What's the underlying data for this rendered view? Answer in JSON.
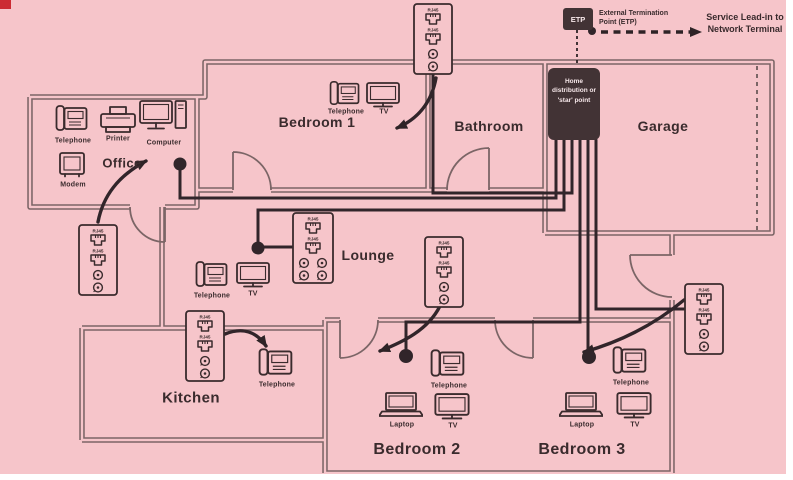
{
  "palette": {
    "background": "#f6c5ca",
    "wall": "#7b6566",
    "ink": "#3a2b2d",
    "dark_box": "#423335",
    "corner_mark_red": "#cc2b33"
  },
  "rooms": {
    "office": "Office",
    "bedroom1": "Bedroom 1",
    "bathroom": "Bathroom",
    "garage": "Garage",
    "lounge": "Lounge",
    "kitchen": "Kitchen",
    "bedroom2": "Bedroom 2",
    "bedroom3": "Bedroom 3"
  },
  "devices": {
    "telephone": "Telephone",
    "printer": "Printer",
    "computer": "Computer",
    "modem": "Modem",
    "tv": "TV",
    "laptop": "Laptop"
  },
  "network": {
    "etp_box": "ETP",
    "etp_label": "External Termination Point (ETP)",
    "service_label": "Service Lead-in to Network Terminal",
    "star_label": "Home distribution or 'star' point",
    "jack": "RJ45"
  }
}
